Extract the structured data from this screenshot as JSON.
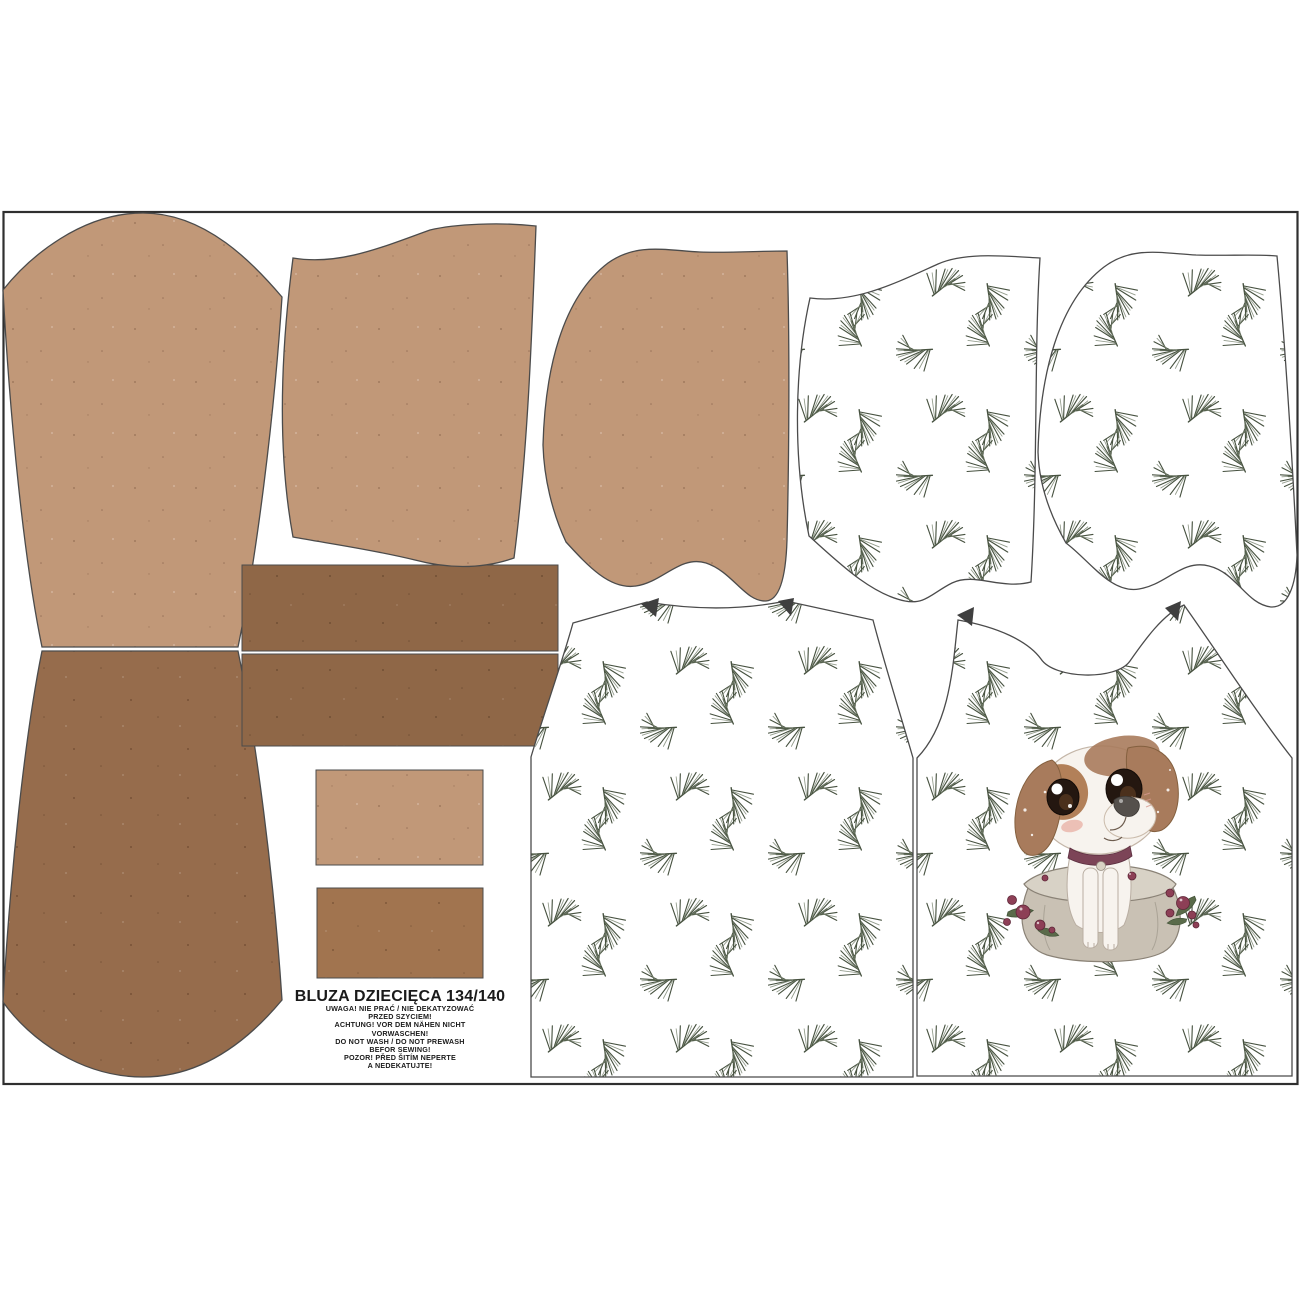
{
  "panel": {
    "title": "BLUZA DZIECIĘCA 134/140",
    "care_lines": [
      "UWAGA! NIE PRAĆ / NIE DEKATYZOWAĆ",
      "PRZED SZYCIEM!",
      "ACHTUNG! VOR DEM NÄHEN NICHT",
      "VORWASCHEN!",
      "DO NOT WASH / DO NOT PREWASH",
      "BEFOR SEWING!",
      "POZOR! PŘED ŠITÍM NEPERTE",
      "A NEDEKATUJTE!"
    ]
  },
  "pieces": {
    "sleeve_upper": "sleeve-upper",
    "sleeve_lower": "sleeve-lower",
    "waistband_top": "waistband-top",
    "waistband_bottom": "waistband-bottom",
    "cuff_small_tan": "cuff-small-tan",
    "cuff_small_brown": "cuff-small-brown",
    "hood_tan_left": "hood-tan-left",
    "hood_tan_right": "hood-tan-right",
    "hood_print_left": "hood-print-left",
    "hood_print_right": "hood-print-right",
    "bodice_back": "bodice-back",
    "bodice_front": "bodice-front",
    "motif": "puppy-in-sack"
  },
  "colors": {
    "tan": "#c19878",
    "brown": "#966c4c",
    "brown_dark": "#8f6747",
    "brown_mid": "#a1744f",
    "fabric_white": "#ffffff",
    "twig_green": "#46513f",
    "twig_light": "#78836f",
    "outline": "#4b4b4b",
    "border": "#2f2f2f",
    "ear_brown": "#a87b5c",
    "patch_brown": "#b28059",
    "collar_plum": "#7c4457",
    "berry": "#8d3f56",
    "holly_green": "#5a6b4a",
    "sack_beige": "#c9c1b4",
    "sack_rim": "#d8d2c6",
    "dog_white": "#f7f3ee"
  }
}
